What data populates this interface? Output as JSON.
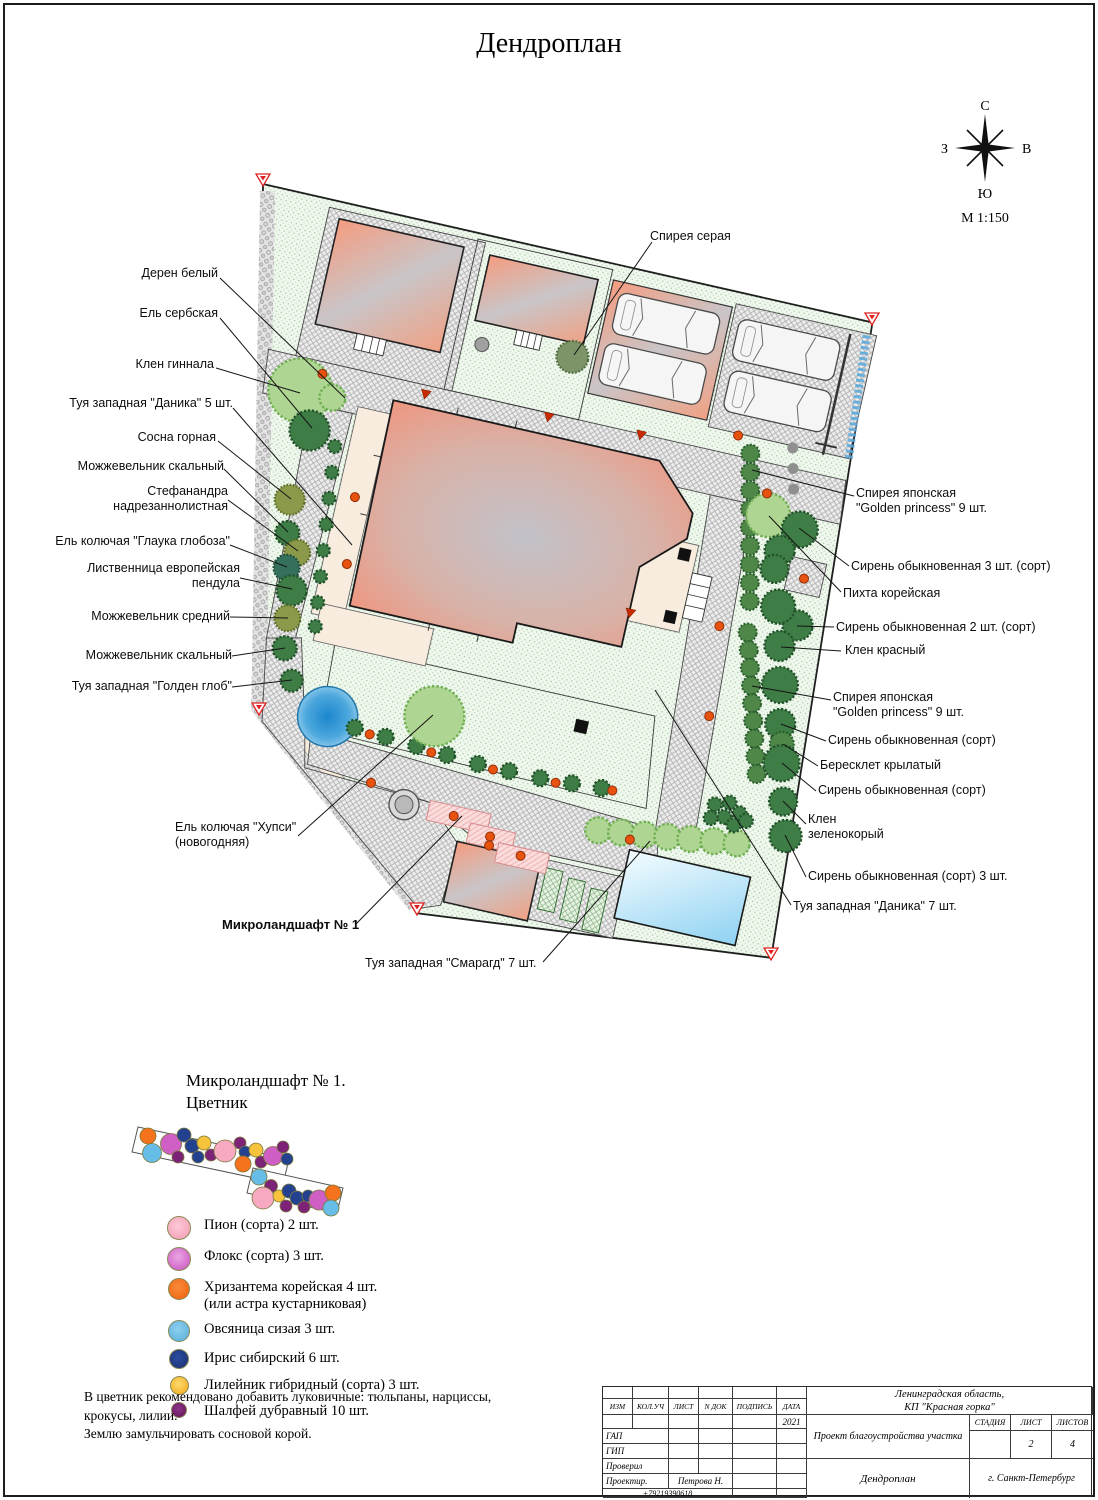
{
  "page": {
    "title": "Дендроплан"
  },
  "compass": {
    "north": "С",
    "south": "Ю",
    "west": "З",
    "east": "В",
    "scale": "М  1:150"
  },
  "plan": {
    "labels": [
      {
        "name": "label-deren-belyi",
        "text": "Дерен белый",
        "x": 218,
        "y": 266,
        "align": "right"
      },
      {
        "name": "label-el-serbskaya",
        "text": "Ель сербская",
        "x": 218,
        "y": 306,
        "align": "right"
      },
      {
        "name": "label-klen-ginnala",
        "text": "Клен гиннала",
        "x": 214,
        "y": 357,
        "align": "right"
      },
      {
        "name": "label-tuya-danika-5",
        "text": "Туя западная \"Даника\" 5 шт.",
        "x": 233,
        "y": 396,
        "align": "right"
      },
      {
        "name": "label-sosna-gornaya",
        "text": "Сосна горная",
        "x": 216,
        "y": 430,
        "align": "right"
      },
      {
        "name": "label-mozhzhevelnik-skalnyi-1",
        "text": "Можжевельник скальный",
        "x": 224,
        "y": 459,
        "align": "right"
      },
      {
        "name": "label-stefanandra",
        "text": "Стефанандра\nнадрезаннолистная",
        "x": 228,
        "y": 484,
        "align": "right"
      },
      {
        "name": "label-el-glauka-globoza",
        "text": "Ель колючая \"Глаука глобоза\"",
        "x": 230,
        "y": 534,
        "align": "right"
      },
      {
        "name": "label-listvennitsa",
        "text": "Лиственница европейская\nпендула",
        "x": 240,
        "y": 561,
        "align": "right"
      },
      {
        "name": "label-mozhzhevelnik-srednii",
        "text": "Можжевельник средний",
        "x": 230,
        "y": 609,
        "align": "right"
      },
      {
        "name": "label-mozhzhevelnik-skalnyi-2",
        "text": "Можжевельник скальный",
        "x": 232,
        "y": 648,
        "align": "right"
      },
      {
        "name": "label-tuya-golden-glob",
        "text": "Туя западная \"Голден глоб\"",
        "x": 232,
        "y": 679,
        "align": "right"
      },
      {
        "name": "label-spireya-seraya",
        "text": "Спирея серая",
        "x": 650,
        "y": 229,
        "align": "left"
      },
      {
        "name": "label-spireya-yaponskaya-1",
        "text": "Спирея японская\n\"Golden princess\" 9 шт.",
        "x": 856,
        "y": 486,
        "align": "left"
      },
      {
        "name": "label-siren-3sht",
        "text": "Сирень обыкновенная 3 шт. (сорт)",
        "x": 851,
        "y": 559,
        "align": "left"
      },
      {
        "name": "label-pikhta-koreiskaya",
        "text": "Пихта корейская",
        "x": 843,
        "y": 586,
        "align": "left"
      },
      {
        "name": "label-siren-2sht",
        "text": "Сирень обыкновенная 2 шт. (сорт)",
        "x": 836,
        "y": 620,
        "align": "left"
      },
      {
        "name": "label-klen-krasnyi",
        "text": "Клен красный",
        "x": 845,
        "y": 643,
        "align": "left"
      },
      {
        "name": "label-spireya-yaponskaya-2",
        "text": "Спирея японская\n\"Golden princess\" 9 шт.",
        "x": 833,
        "y": 690,
        "align": "left"
      },
      {
        "name": "label-siren-sort-1",
        "text": "Сирень обыкновенная (сорт)",
        "x": 828,
        "y": 733,
        "align": "left"
      },
      {
        "name": "label-beresklet",
        "text": "Бересклет крылатый",
        "x": 820,
        "y": 758,
        "align": "left"
      },
      {
        "name": "label-siren-sort-2",
        "text": "Сирень обыкновенная (сорт)",
        "x": 818,
        "y": 783,
        "align": "left"
      },
      {
        "name": "label-klen-zelenokoryi",
        "text": "Клен\nзеленокорый",
        "x": 808,
        "y": 812,
        "align": "left"
      },
      {
        "name": "label-siren-sort-3sht",
        "text": "Сирень обыкновенная (сорт) 3 шт.",
        "x": 808,
        "y": 869,
        "align": "left"
      },
      {
        "name": "label-tuya-danika-7",
        "text": "Туя западная \"Даника\" 7 шт.",
        "x": 793,
        "y": 899,
        "align": "left"
      },
      {
        "name": "label-el-khupsi",
        "text": "Ель колючая \"Хупси\"\n(новогодняя)",
        "x": 175,
        "y": 820,
        "align": "left"
      },
      {
        "name": "label-mikrolandshaft-1",
        "text": "Микроландшафт № 1",
        "x": 222,
        "y": 917,
        "align": "left",
        "bold": true
      },
      {
        "name": "label-tuya-smaragd",
        "text": "Туя западная \"Смарагд\" 7 шт.",
        "x": 365,
        "y": 956,
        "align": "left"
      }
    ]
  },
  "microlandscape": {
    "title_line1": "Микроландшафт № 1.",
    "title_line2": "Цветник"
  },
  "legend": {
    "items": [
      {
        "name": "legend-pion",
        "label": "Пион (сорта) 2 шт.",
        "color": "#f49ab4",
        "color2": "#fcc9d6",
        "d": 22
      },
      {
        "name": "legend-floks",
        "label": "Флокс (сорта) 3 шт.",
        "color": "#c94fbe",
        "color2": "#eaa6e3",
        "d": 22
      },
      {
        "name": "legend-khrizantema",
        "label": "Хризантема корейская 4 шт.",
        "label2": "(или астра кустарниковая)",
        "color": "#ef5f0c",
        "color2": "#f88b3a",
        "d": 20
      },
      {
        "name": "legend-ovsyanitsa",
        "label": "Овсяница сизая 3 шт.",
        "color": "#55acd9",
        "color2": "#8fd0ef",
        "d": 20
      },
      {
        "name": "legend-iris",
        "label": "Ирис сибирский 6 шт.",
        "color": "#1a2f6e",
        "color2": "#2c4da0",
        "d": 18
      },
      {
        "name": "legend-lileinik",
        "label": "Лилейник гибридный (сорта) 3 шт.",
        "color": "#f0a816",
        "color2": "#fdd96e",
        "d": 17
      },
      {
        "name": "legend-shalfei",
        "label": "Шалфей дубравный 10 шт.",
        "color": "#611458",
        "color2": "#8e3689",
        "d": 14
      }
    ]
  },
  "notes": {
    "line1": "В цветник рекомендовано добавить луковичные: тюльпаны, нарциссы,",
    "line2": "крокусы, лилии.",
    "line3": "Землю замульчировать сосновой корой."
  },
  "titleblock": {
    "header_cols": [
      "ИЗМ",
      "КОЛ.УЧ",
      "ЛИСТ",
      "N ДОК",
      "ПОДПИСЬ",
      "ДАТА"
    ],
    "date_value": "2021",
    "rows": [
      "ГАП",
      "ГИП",
      "Проверил",
      "Проектир."
    ],
    "designer_name": "Петрова Н.",
    "phone": "+79219390618",
    "region_line1": "Ленинградская  область,",
    "region_line2": "КП  \"Красная  горка\"",
    "project": "Проект  благоустройства  участка",
    "stage_label": "СТАДИЯ",
    "sheet_label": "ЛИСТ",
    "sheets_label": "ЛИСТОВ",
    "stage_value": "",
    "sheet_value": "2",
    "sheets_value": "4",
    "doc_title": "Дендроплан",
    "city": "г.  Санкт-Петербург"
  }
}
